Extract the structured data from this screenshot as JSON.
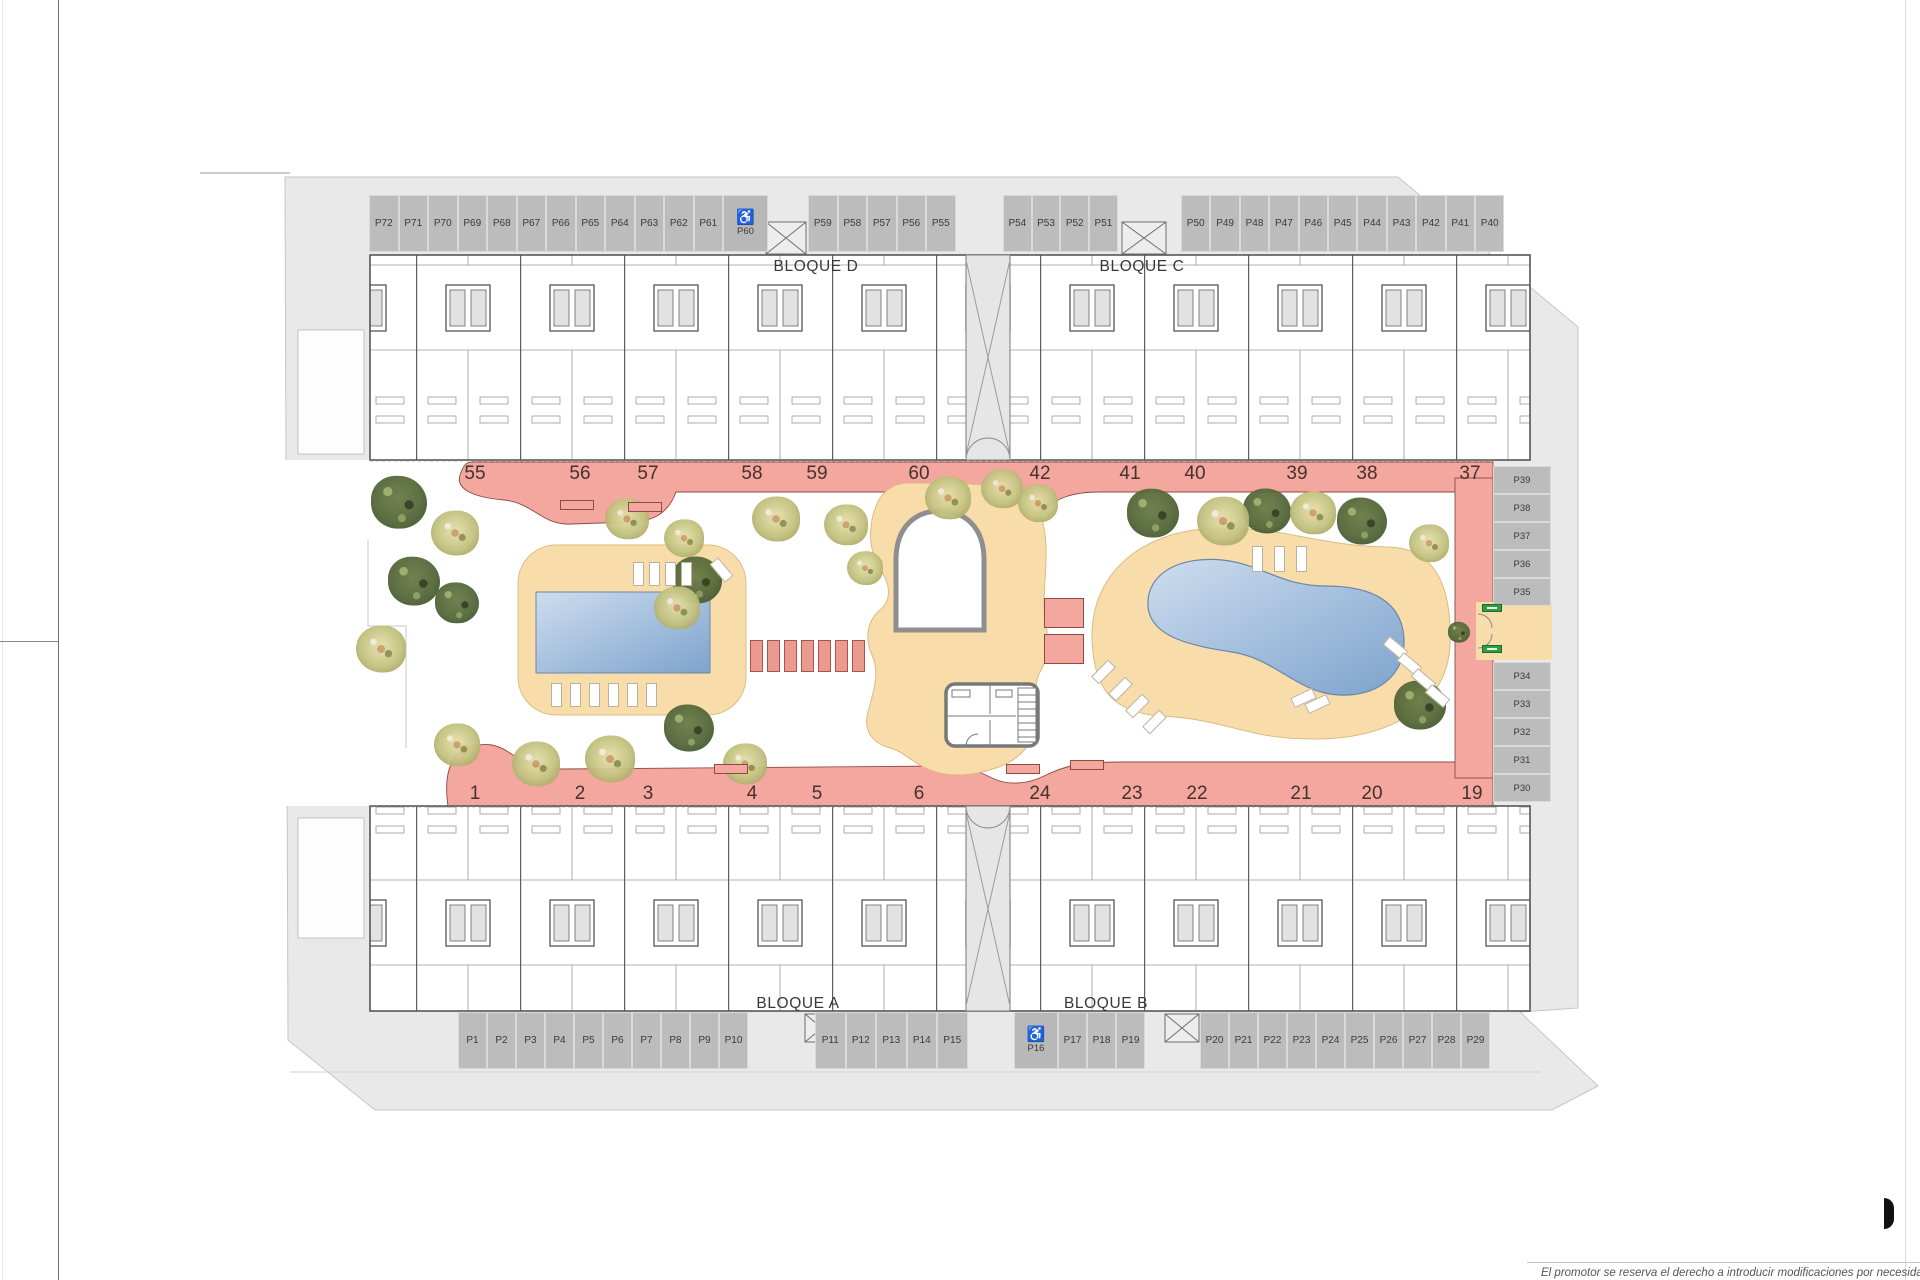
{
  "plan": {
    "blocks": {
      "top_left": "BLOQUE D",
      "top_right": "BLOQUE C",
      "bottom_left": "BLOQUE A",
      "bottom_right": "BLOQUE B"
    },
    "parking": {
      "top_row": {
        "group1": [
          "P72",
          "P71",
          "P70",
          "P69",
          "P68",
          "P67",
          "P66",
          "P65",
          "P64",
          "P63",
          "P62",
          "P61"
        ],
        "accessible": "P60",
        "group2": [
          "P59",
          "P58",
          "P57",
          "P56",
          "P55"
        ],
        "group3": [
          "P54",
          "P53",
          "P52",
          "P51"
        ],
        "group4": [
          "P50",
          "P49",
          "P48",
          "P47",
          "P46",
          "P45",
          "P44",
          "P43",
          "P42",
          "P41",
          "P40"
        ]
      },
      "right_column": {
        "upper": [
          "P39",
          "P38",
          "P37",
          "P36",
          "P35"
        ],
        "lower": [
          "P34",
          "P33",
          "P32",
          "P31",
          "P30"
        ]
      },
      "bottom_row": {
        "group1": [
          "P1",
          "P2",
          "P3",
          "P4",
          "P5",
          "P6",
          "P7",
          "P8",
          "P9",
          "P10"
        ],
        "group2": [
          "P11",
          "P12",
          "P13",
          "P14",
          "P15"
        ],
        "accessible": "P16",
        "group3": [
          "P17",
          "P18",
          "P19"
        ],
        "group4": [
          "P20",
          "P21",
          "P22",
          "P23",
          "P24",
          "P25",
          "P26",
          "P27",
          "P28",
          "P29"
        ]
      }
    },
    "unit_numbers": {
      "top": [
        "55",
        "56",
        "57",
        "58",
        "59",
        "60",
        "42",
        "41",
        "40",
        "39",
        "38",
        "37"
      ],
      "bottom": [
        "1",
        "2",
        "3",
        "4",
        "5",
        "6",
        "24",
        "23",
        "22",
        "21",
        "20",
        "19"
      ]
    },
    "icons": {
      "accessible": "♿"
    },
    "disclaimer": "El promotor se reserva el derecho a introducir modificaciones por necesidad de índole técnica o legal",
    "colors": {
      "site": "#e9e9e9",
      "walkway": "#f3a79e",
      "deck": "#f8dcaa",
      "pool_light": "#c9dbed",
      "pool_dark": "#7ea3cd",
      "stall": "#bcbcbc",
      "sign_green": "#2f9e41"
    }
  }
}
